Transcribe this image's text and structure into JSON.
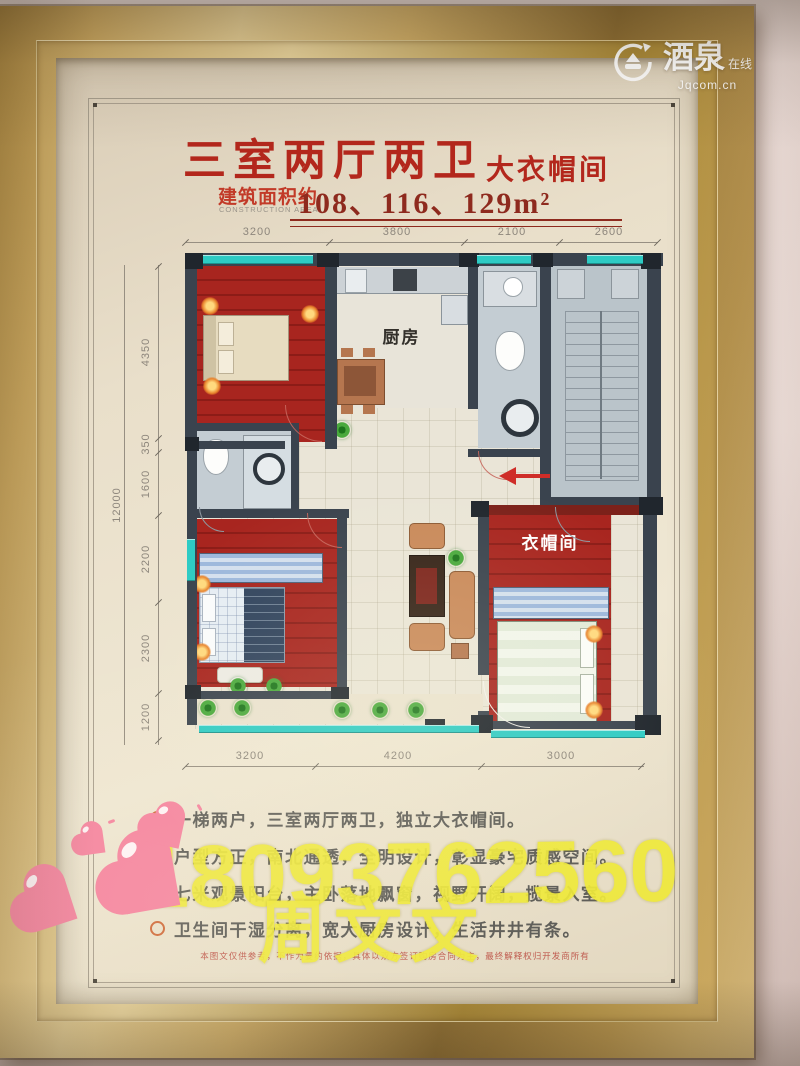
{
  "site_badge": {
    "name": "酒泉",
    "suffix": "在线",
    "url": "Jqcom.cn"
  },
  "poster": {
    "title": "三室两厅两卫",
    "title_tag": "大衣帽间",
    "area_label": "建筑面积约",
    "area_label_en": "CONSTRUCTION AREA",
    "area_values": "108、116、129m²",
    "plan": {
      "room_labels": {
        "kitchen": "厨房",
        "cloakroom": "衣帽间"
      },
      "dims_top": [
        "3200",
        "3800",
        "2100",
        "2600"
      ],
      "dims_left_total": "12000",
      "dims_left": [
        "4350",
        "350",
        "1600",
        "2200",
        "2300",
        "1200"
      ],
      "dims_bottom": [
        "3200",
        "4200",
        "3000"
      ]
    },
    "features": [
      "一梯两户，三室两厅两卫，独立大衣帽间。",
      "户型方正，南北通透，全明设计，彰显豪宅质感空间。",
      "七米观景阳台，主卧落地飘窗，视野开阔，揽景入室。",
      "卫生间干湿分离，宽大厨房设计，生活井井有条。"
    ],
    "disclaimer": "本图文仅供参考，不作为要约依据，具体以双方签订购房合同为主，最终解释权归开发商所有"
  },
  "watermark": {
    "phone": "18093762560",
    "name": "周文文"
  },
  "colors": {
    "frame_gold": "#c2a058",
    "poster_cream": "#e9decb",
    "title_red": "#b3271c",
    "number_red": "#8e2a1e",
    "wall_dark": "#3a434e",
    "floor_red": "#a1241f",
    "window_teal": "#2ecbc4",
    "dim_grey": "#8d867c",
    "watermark_yellow": "#efe93b",
    "heart_pink": "#f585a0"
  }
}
